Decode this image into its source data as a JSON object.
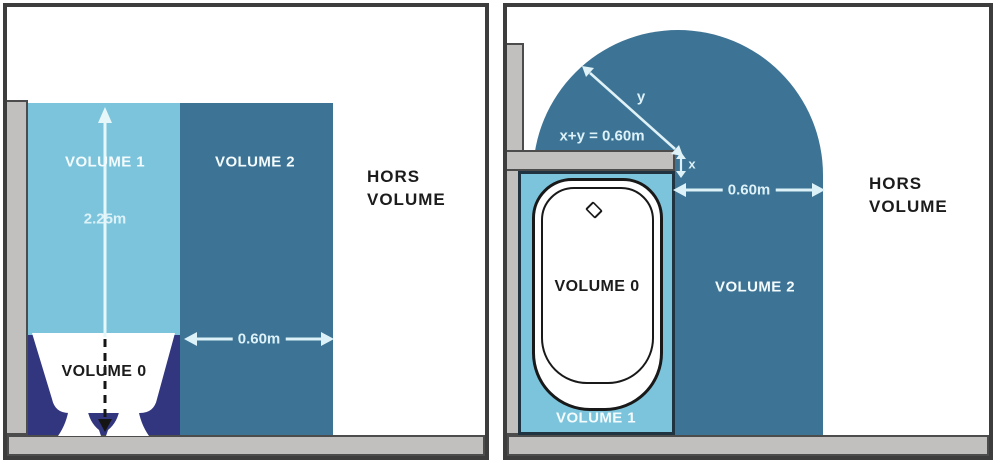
{
  "figure": {
    "type": "bathroom-electrical-volumes-diagram",
    "views": [
      "side-elevation",
      "plan-view"
    ]
  },
  "colors": {
    "volume1": "#7cc4dc",
    "volume2": "#3d7394",
    "volume0": "#32367e",
    "wall": "#c1c0be",
    "panel_border": "#3d3d3d",
    "dimension_arrow": "#dcf2f8",
    "label_light": "#f4fbfd",
    "label_dark": "#1c1c1c"
  },
  "left_panel": {
    "labels": {
      "volume1": "VOLUME 1",
      "volume2": "VOLUME 2",
      "volume0": "VOLUME 0",
      "hors_line1": "HORS",
      "hors_line2": "VOLUME"
    },
    "dimensions": {
      "height": "2.25m",
      "width": "0.60m"
    }
  },
  "right_panel": {
    "labels": {
      "volume0": "VOLUME 0",
      "volume1": "VOLUME 1",
      "volume2": "VOLUME 2",
      "hors_line1": "HORS",
      "hors_line2": "VOLUME"
    },
    "dimensions": {
      "width": "0.60m",
      "equation": "x+y = 0.60m",
      "x_label": "x",
      "y_label": "y"
    }
  }
}
